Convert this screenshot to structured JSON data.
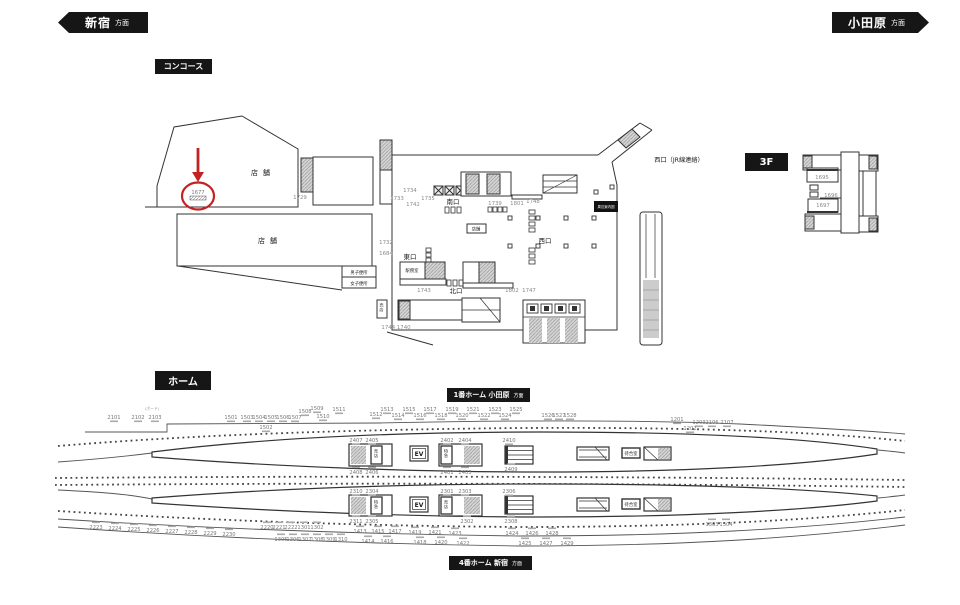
{
  "tags": {
    "left_station": "新宿",
    "left_suffix": "方面",
    "right_station": "小田原",
    "right_suffix": "方面",
    "concourse": "コンコース",
    "home": "ホーム",
    "floor3": "3F",
    "platform1_main": "1番ホーム 小田原",
    "platform1_suffix": "方面",
    "platform4_main": "4番ホーム 新宿",
    "platform4_suffix": "方面"
  },
  "concourse": {
    "west_jr_label": "西口（JR線連絡）",
    "shop_upper": "店舗",
    "shop_lower": "店舗",
    "shop_box": "店舗",
    "south_exit": "南口",
    "east_exit": "東口",
    "north_exit": "北口",
    "west_exit": "西口",
    "station_office": "駅務室",
    "mens_toilet": "男子便所",
    "womens_toilet": "女子便所",
    "kiosk": "売店",
    "area_map": "周辺案内図",
    "highlight_number": "1677",
    "numbers": [
      "1729",
      "1734",
      "1733",
      "1742",
      "1735",
      "1739",
      "1801",
      "1748",
      "1732",
      "1684",
      "1743",
      "1802",
      "1747",
      "1744 1740"
    ]
  },
  "floor3": {
    "numbers": [
      "1695",
      "1696",
      "1697"
    ]
  },
  "platform": {
    "board_note": "(ボード)",
    "ev": "EV",
    "kiosk": "売店",
    "ltd_exp": "特急",
    "waiting_room": "待合室",
    "p1_above": [
      "2101",
      "2102",
      "2103",
      "1501",
      "1503",
      "1504",
      "1505",
      "1506",
      "1507",
      "1502",
      "1508",
      "1509",
      "1510",
      "1511",
      "1512",
      "1513",
      "1514",
      "1515",
      "1516",
      "1517",
      "1518",
      "1519",
      "1520",
      "1521",
      "1522",
      "1523",
      "1524",
      "1525",
      "1526",
      "1527",
      "1528",
      "1201",
      "1203",
      "2106",
      "2107",
      "1202"
    ],
    "p1_inside_top": [
      "2407",
      "2405",
      "2402",
      "2404",
      "2410"
    ],
    "p1_inside_bottom": [
      "2408",
      "2406",
      "2401",
      "2403",
      "2409"
    ],
    "p2_inside_top": [
      "2310",
      "2304",
      "2301",
      "2303",
      "2306"
    ],
    "p2_inside_bottom": [
      "2311",
      "2305",
      "2302",
      "2308"
    ],
    "p2_below": [
      "2223",
      "2224",
      "2225",
      "2226",
      "2227",
      "2228",
      "2229",
      "2230",
      "2220",
      "2221",
      "2222",
      "1301",
      "1302",
      "1305",
      "1306",
      "1307",
      "1308",
      "1309",
      "1310",
      "1413",
      "1415",
      "1417",
      "1419",
      "1421",
      "1423",
      "1414",
      "1416",
      "1418",
      "1420",
      "1422",
      "1424",
      "1426",
      "1428",
      "1425",
      "1427",
      "1429",
      "1303",
      "1304"
    ]
  },
  "colors": {
    "highlight": "#c42222",
    "tag_bg": "#161616",
    "line": "#333333",
    "number": "#787878"
  }
}
